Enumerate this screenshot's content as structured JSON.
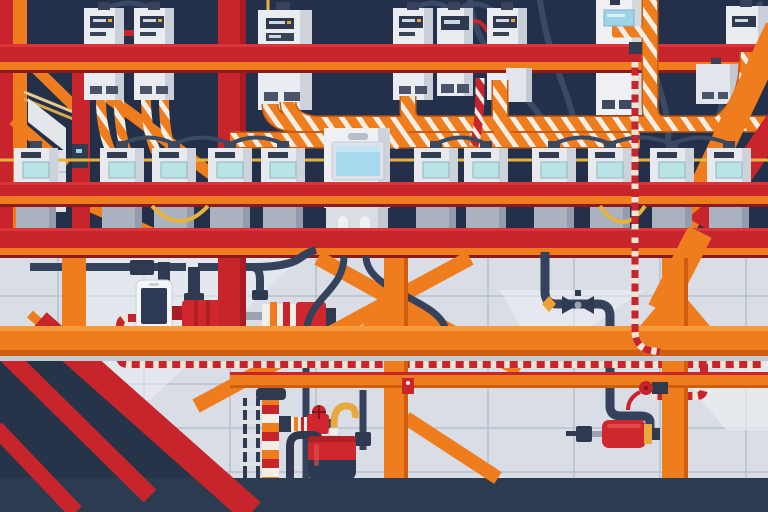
{
  "scene": {
    "title": "Flat vector illustration of an industrial electrical meter room with scaffolding, conduits and pumping equipment",
    "description": "Rows of electric meter boxes mounted on a dark navy wall, red and orange structural steel beams and braces, orange-and-white striped conduits, a red-and-white dashed cable run, a smartphone plugged into a red inline motor, a valve pipeline with a red canister filter, and a floor pump station with a red drum and hook hose over a light grey tiled wall.",
    "palette": {
      "navy": "#24304a",
      "navy_floor_left": "#253449",
      "floor": "#2b3c50",
      "red": "#c8242b",
      "red_bright": "#d9353b",
      "red_dark": "#8c1a1f",
      "orange": "#ef7d1e",
      "orange_light": "#f79b3a",
      "orange_dark": "#cf5f0e",
      "stripe_white": "#f3efe6",
      "yellow": "#e8b33c",
      "cable": "#35425c",
      "device_body": "#e9ecf1",
      "device_shade": "#c9cfd9",
      "display_dark": "#2e3950",
      "screen_teal": "#b9e4e6",
      "screen_blue": "#a7d9ee",
      "wall": "#d9dee6",
      "grid_line": "#b6bfcc"
    },
    "meter_rows": {
      "tall_top": {
        "label": "tall wall meters behind upper red beam",
        "y": 8,
        "w": 40,
        "h": 92,
        "x": [
          84,
          134,
          393,
          487
        ]
      },
      "shelf": {
        "label": "meters standing on red shelf beam",
        "y": 148,
        "w": 44,
        "h": 38,
        "x": [
          14,
          100,
          152,
          208,
          261,
          414,
          464,
          532,
          588,
          650,
          707
        ]
      }
    },
    "objects": {
      "control_unit": "central control panel with large blue screen and three buttons",
      "smartphone": "smartphone connected to red inline motor by plug",
      "dashed_cable": "red and white dashed cable run looping from the phone across the wall",
      "valve_line": "dark pipeline with butterfly valve and orange fitting",
      "canister": "red filter canister with black plug and yellow ring",
      "pump_station": "striped stand pipe, red hand valve, J faucet, red drum, yellow hook hose",
      "beams": [
        "upper red beam",
        "red shelf beam",
        "lower red beam",
        "orange mid beam",
        "orange rail"
      ],
      "columns": [
        "left red column",
        "left orange column",
        "inner red column",
        "two orange wall columns"
      ]
    }
  }
}
